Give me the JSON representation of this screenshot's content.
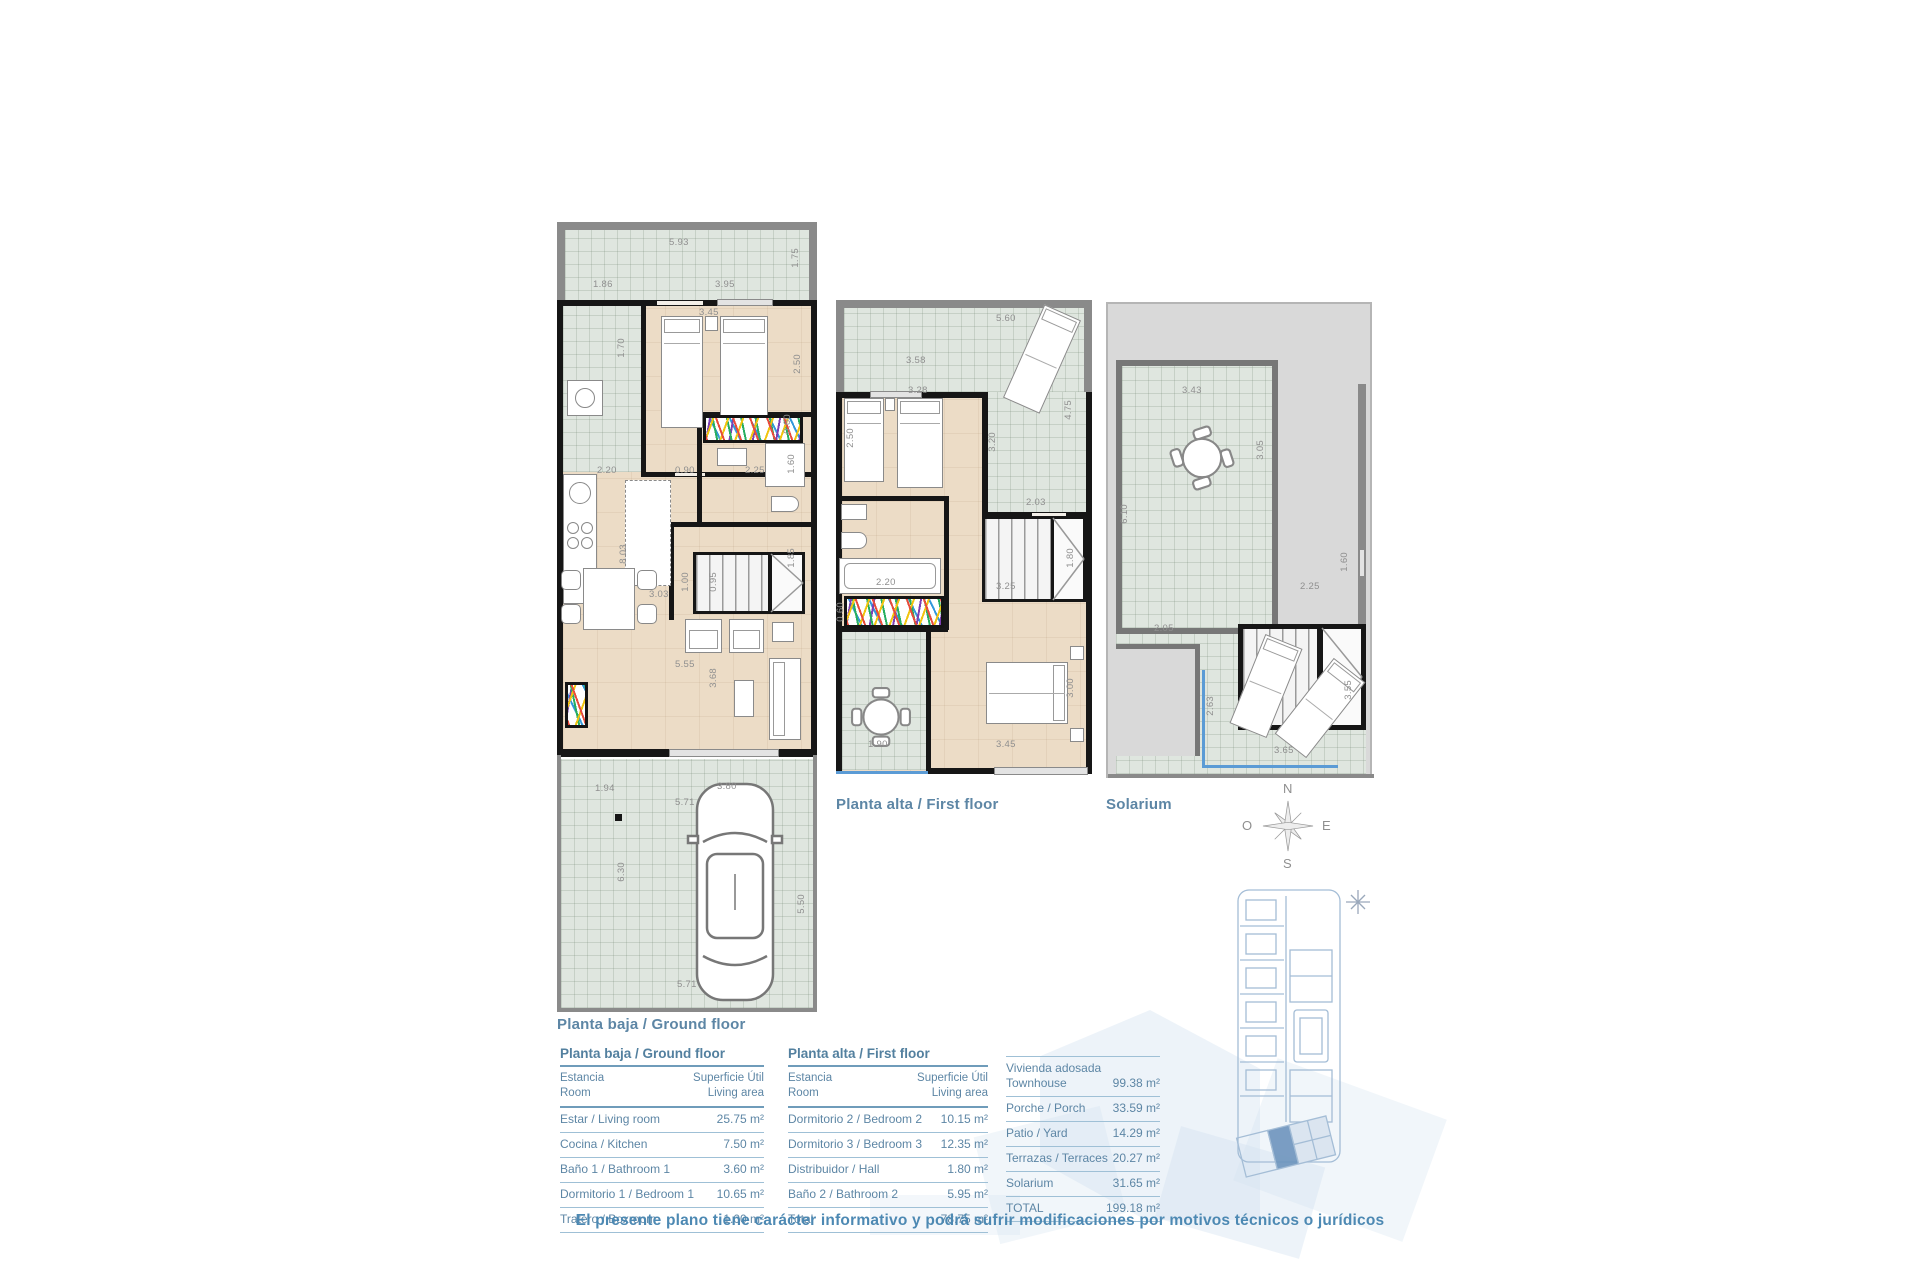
{
  "colors": {
    "accent_text": "#5d86a5",
    "footer_text": "#4d89b3",
    "tile": "#dfe6df",
    "floor": "#ecdcc6",
    "wall": "#161616",
    "highlight_unit": "#6d93bd",
    "rail_blue": "#5b9bd5"
  },
  "plans": [
    {
      "label": "Planta baja / Ground floor",
      "dims": [
        {
          "v": "5.93",
          "x": 112,
          "y": 16
        },
        {
          "v": "1.75",
          "x": 234,
          "y": 26,
          "r": 1
        },
        {
          "v": "1.86",
          "x": 36,
          "y": 58
        },
        {
          "v": "3.95",
          "x": 158,
          "y": 58
        },
        {
          "v": "3.45",
          "x": 142,
          "y": 86
        },
        {
          "v": "2.50",
          "x": 236,
          "y": 132,
          "r": 1
        },
        {
          "v": "1.70",
          "x": 60,
          "y": 116,
          "r": 1
        },
        {
          "v": "2.20",
          "x": 40,
          "y": 244
        },
        {
          "v": "0.90",
          "x": 118,
          "y": 244
        },
        {
          "v": "2.25",
          "x": 188,
          "y": 244
        },
        {
          "v": "1.60",
          "x": 230,
          "y": 232,
          "r": 1
        },
        {
          "v": "0.60",
          "x": 226,
          "y": 192,
          "r": 1
        },
        {
          "v": "8.03",
          "x": 62,
          "y": 322,
          "r": 1
        },
        {
          "v": "1.00",
          "x": 124,
          "y": 350,
          "r": 1
        },
        {
          "v": "0.95",
          "x": 152,
          "y": 350,
          "r": 1
        },
        {
          "v": "1.85",
          "x": 230,
          "y": 326,
          "r": 1
        },
        {
          "v": "3.03",
          "x": 92,
          "y": 368
        },
        {
          "v": "5.55",
          "x": 118,
          "y": 438
        },
        {
          "v": "3.68",
          "x": 152,
          "y": 446,
          "r": 1
        },
        {
          "v": "1.94",
          "x": 38,
          "y": 562
        },
        {
          "v": "3.80",
          "x": 160,
          "y": 560
        },
        {
          "v": "5.71",
          "x": 118,
          "y": 576
        },
        {
          "v": "6.30",
          "x": 60,
          "y": 640,
          "r": 1
        },
        {
          "v": "5.50",
          "x": 240,
          "y": 672,
          "r": 1
        },
        {
          "v": "5.71",
          "x": 120,
          "y": 758
        }
      ]
    },
    {
      "label": "Planta alta / First floor",
      "dims": [
        {
          "v": "5.60",
          "x": 160,
          "y": 14
        },
        {
          "v": "3.58",
          "x": 70,
          "y": 56
        },
        {
          "v": "4.75",
          "x": 228,
          "y": 100,
          "r": 1
        },
        {
          "v": "3.28",
          "x": 72,
          "y": 86
        },
        {
          "v": "2.50",
          "x": 10,
          "y": 128,
          "r": 1
        },
        {
          "v": "3.20",
          "x": 152,
          "y": 132,
          "r": 1
        },
        {
          "v": "2.03",
          "x": 190,
          "y": 198
        },
        {
          "v": "1.80",
          "x": 230,
          "y": 248,
          "r": 1
        },
        {
          "v": "2.20",
          "x": 40,
          "y": 278
        },
        {
          "v": "3.25",
          "x": 160,
          "y": 282
        },
        {
          "v": "0.60",
          "x": 0,
          "y": 302,
          "r": 1
        },
        {
          "v": "3.00",
          "x": 230,
          "y": 378,
          "r": 1
        },
        {
          "v": "3.45",
          "x": 160,
          "y": 440
        },
        {
          "v": "1.90",
          "x": 32,
          "y": 440
        }
      ]
    },
    {
      "label": "Solarium",
      "dims": [
        {
          "v": "3.43",
          "x": 74,
          "y": 82
        },
        {
          "v": "3.05",
          "x": 148,
          "y": 136,
          "r": 1
        },
        {
          "v": "6.10",
          "x": 12,
          "y": 200,
          "r": 1
        },
        {
          "v": "1.60",
          "x": 232,
          "y": 248,
          "r": 1
        },
        {
          "v": "2.25",
          "x": 192,
          "y": 278
        },
        {
          "v": "2.05",
          "x": 46,
          "y": 320
        },
        {
          "v": "2.63",
          "x": 98,
          "y": 392,
          "r": 1
        },
        {
          "v": "3.55",
          "x": 236,
          "y": 376,
          "r": 1
        },
        {
          "v": "3.65",
          "x": 166,
          "y": 442
        }
      ]
    }
  ],
  "compass": {
    "north": "N",
    "south": "S",
    "east": "E",
    "west": "O"
  },
  "tables": [
    {
      "title": "Planta baja / Ground floor",
      "header": {
        "col1a": "Estancia",
        "col1b": "Room",
        "col2a": "Superficie Útil",
        "col2b": "Living area"
      },
      "rows": [
        {
          "label": "Estar / Living room",
          "value": "25.75 m²"
        },
        {
          "label": "Cocina / Kitchen",
          "value": "7.50 m²"
        },
        {
          "label": "Baño 1 / Bathroom 1",
          "value": "3.60 m²"
        },
        {
          "label": "Dormitorio 1 / Bedroom 1",
          "value": "10.65 m²"
        },
        {
          "label": "Tratero / Boxroom",
          "value": "1.00 m²"
        }
      ]
    },
    {
      "title": "Planta alta / First floor",
      "header": {
        "col1a": "Estancia",
        "col1b": "Room",
        "col2a": "Superficie Útil",
        "col2b": "Living area"
      },
      "rows": [
        {
          "label": "Dormitorio 2 / Bedroom 2",
          "value": "10.15 m²"
        },
        {
          "label": "Dormitorio 3 / Bedroom 3",
          "value": "12.35 m²"
        },
        {
          "label": "Distribuidor / Hall",
          "value": "1.80 m²"
        },
        {
          "label": "Baño 2 / Bathroom 2",
          "value": "5.95 m²"
        },
        {
          "label": "Total",
          "value": "78.75 m²"
        }
      ]
    },
    {
      "rows": [
        {
          "label": "Vivienda adosada",
          "label2": "Townhouse",
          "value": "99.38 m²"
        },
        {
          "label": "Porche / Porch",
          "value": "33.59 m²"
        },
        {
          "label": "Patio / Yard",
          "value": "14.29 m²"
        },
        {
          "label": "Terrazas / Terraces",
          "value": "20.27 m²"
        },
        {
          "label": "Solarium",
          "value": "31.65 m²"
        },
        {
          "label": "TOTAL",
          "value": "199.18 m²"
        }
      ]
    }
  ],
  "footer": "El presente plano tiene carácter informativo y podrá sufrir modificaciones por motivos técnicos o jurídicos"
}
